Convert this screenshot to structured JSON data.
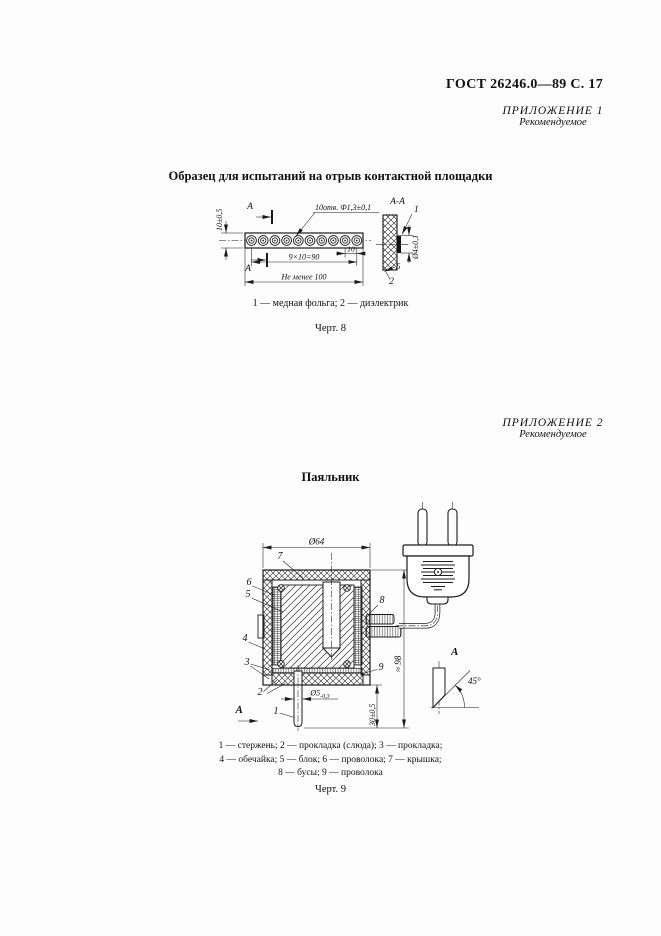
{
  "page": {
    "header": "ГОСТ 26246.0—89 С. 17"
  },
  "appendix1": {
    "title": "ПРИЛОЖЕНИЕ 1",
    "subtitle": "Рекомендуемое"
  },
  "appendix2": {
    "title": "ПРИЛОЖЕНИЕ 2",
    "subtitle": "Рекомендуемое"
  },
  "fig8": {
    "title": "Образец для испытаний на отрыв контактной площадки",
    "legend": "1 — медная фольга; 2 — диэлектрик",
    "caption": "Черт. 8",
    "labels": {
      "section_view": "А-А",
      "section_mark_top": "А",
      "section_mark_bottom": "А",
      "holes": "10отв. Ф1,3±0,1",
      "dim_height": "10±0,5",
      "dim_pitch_total": "9×10=90",
      "dim_pitch": "10",
      "dim_total": "Не менее 100",
      "dim_margin": "5",
      "dim_pad": "Ø4±0,1",
      "callout_foil": "1",
      "callout_dielectric": "2"
    }
  },
  "fig9": {
    "title": "Паяльник",
    "legend": [
      "1 — стержень; 2 — прокладка (слюда); 3 — прокладка;",
      "4 — обечайка; 5 — блок; 6 — проволока; 7 — крышка;",
      "8 — бусы; 9 — проволока"
    ],
    "caption": "Черт. 9",
    "labels": {
      "dim_diameter": "Ø64",
      "dim_rod": "Ø5",
      "dim_rod_tol": "-0,3",
      "dim_rod_len": "30±0,5",
      "dim_overall": "≈ 98",
      "angle": "45°",
      "view_label": "А",
      "view_arrow": "А",
      "c1": "1",
      "c2": "2",
      "c3": "3",
      "c4": "4",
      "c5": "5",
      "c6": "6",
      "c7": "7",
      "c8": "8",
      "c9": "9"
    }
  }
}
